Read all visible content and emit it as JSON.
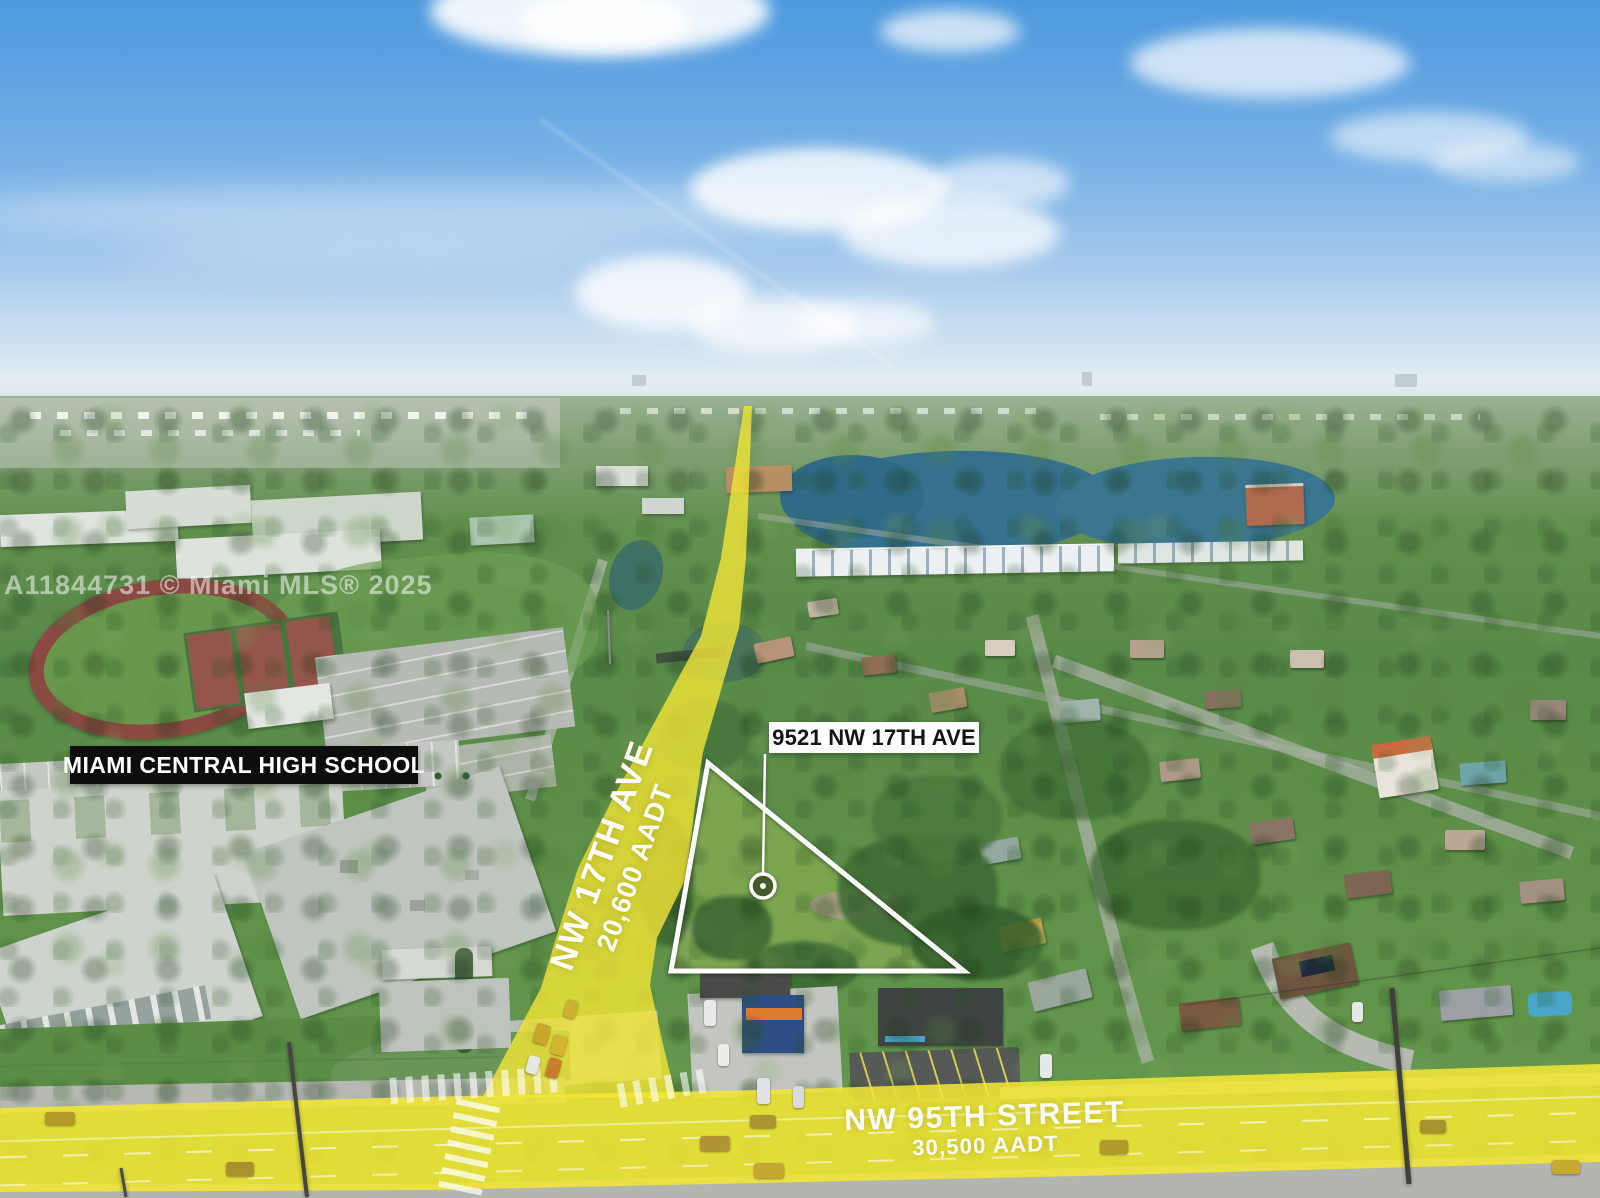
{
  "watermark": {
    "text": "A11844731 © Miami MLS® 2025"
  },
  "labels": {
    "school": "MIAMI CENTRAL HIGH SCHOOL",
    "property_address": "9521 NW 17TH AVE"
  },
  "roads": {
    "vertical": {
      "name": "NW 17TH AVE",
      "aadt": "20,600 AADT"
    },
    "horizontal": {
      "name": "NW 95TH STREET",
      "aadt": "30,500 AADT"
    }
  },
  "colors": {
    "road_highlight": "#F3E636",
    "parcel_outline": "#FFFFFF",
    "school_label_bg": "#0D0D0D",
    "school_label_text": "#FFFFFF",
    "property_label_bg": "#FFFFFF",
    "property_label_text": "#141414",
    "road_text": "#FFFFFF",
    "watermark_color": "#FFFFFF"
  }
}
